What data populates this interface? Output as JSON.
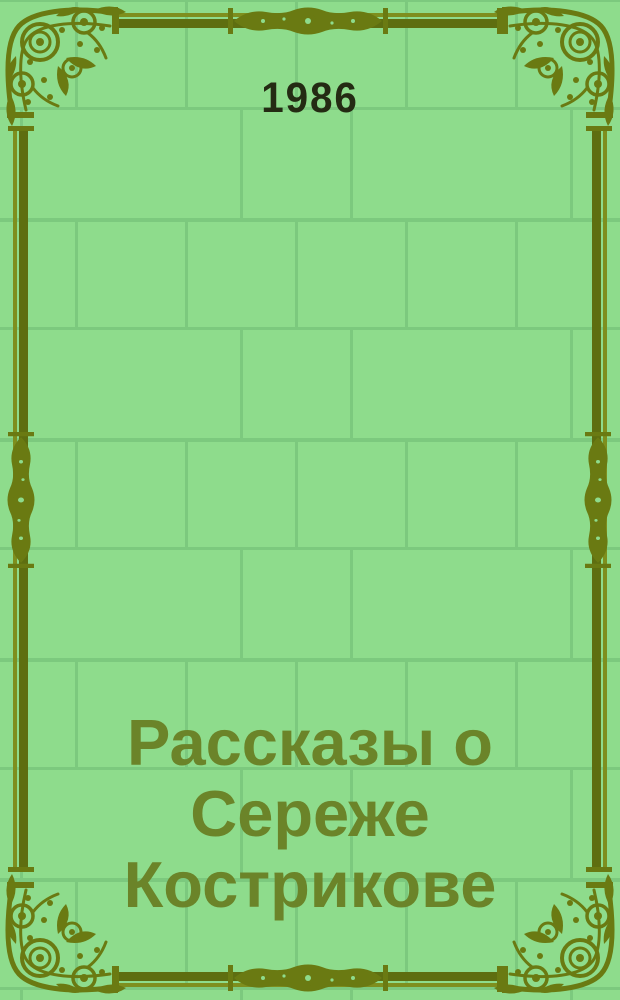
{
  "cover": {
    "year": "1986",
    "title": "Рассказы о Сереже Кострикове",
    "title_lines": [
      "Рассказы о",
      "Сереже",
      "Кострикове"
    ]
  },
  "colors": {
    "background_green": "#8edc8c",
    "brick_grout_green": "#7cc97e",
    "frame_olive": "#6a7a12",
    "frame_olive_light": "#7e8f1e",
    "frame_olive_dark": "#5e6e10",
    "title_green": "#6b8429",
    "year_dark": "#242b13"
  }
}
